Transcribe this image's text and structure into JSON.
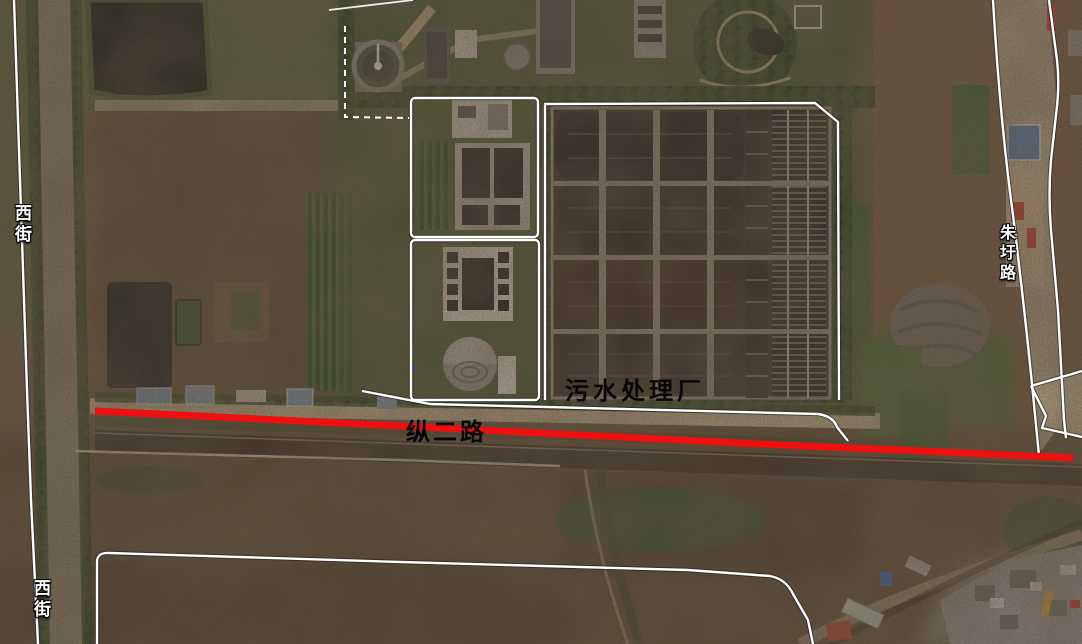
{
  "map": {
    "type": "satellite-imagery",
    "labels": {
      "plant": {
        "text": "污水处理厂"
      },
      "main_road": {
        "text": "纵二路"
      },
      "west_street_top": {
        "text": "西街"
      },
      "west_street_bottom": {
        "text": "西街"
      },
      "east_road": {
        "text": "朱圩路"
      }
    },
    "features": {
      "highlighted_road": {
        "label": "纵二路",
        "color": "#ee1010"
      },
      "road_outline_color": "#ffffff"
    }
  }
}
